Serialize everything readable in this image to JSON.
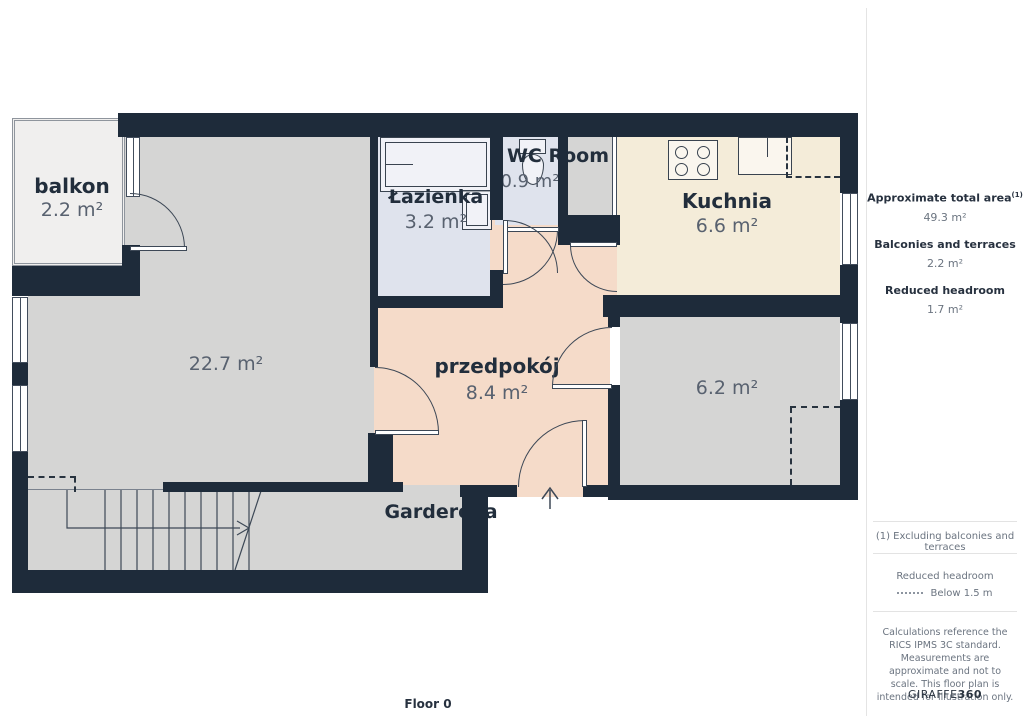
{
  "floor_plan": {
    "floor_label": "Floor 0",
    "rooms": [
      {
        "id": "balkon",
        "name": "balkon",
        "area": "2.2 m²"
      },
      {
        "id": "room_22_7",
        "name": "",
        "area": "22.7 m²"
      },
      {
        "id": "lazienka",
        "name": "Łazienka",
        "area": "3.2 m²"
      },
      {
        "id": "wc",
        "name": "WC Room",
        "area": "0.9 m²"
      },
      {
        "id": "kuchnia",
        "name": "Kuchnia",
        "area": "6.6 m²"
      },
      {
        "id": "przedpokoj",
        "name": "przedpokój",
        "area": "8.4 m²"
      },
      {
        "id": "room_6_2",
        "name": "",
        "area": "6.2 m²"
      },
      {
        "id": "garderoba",
        "name": "Garderoba",
        "area": ""
      }
    ],
    "colors": {
      "wall": "#1e2b3a",
      "room_gray": "#d5d5d4",
      "bathroom_blue": "#dfe3ed",
      "kitchen_beige": "#f4ecd9",
      "hallway_pink": "#f5dbc9",
      "balcony": "#f0efee"
    }
  },
  "sidebar": {
    "stats": [
      {
        "label": "Approximate total area",
        "sup": "(1)",
        "value": "49.3 m²"
      },
      {
        "label": "Balconies and terraces",
        "sup": "",
        "value": "2.2 m²"
      },
      {
        "label": "Reduced headroom",
        "sup": "",
        "value": "1.7 m²"
      }
    ],
    "footnote": "(1) Excluding balconies and terraces",
    "legend": {
      "title": "Reduced headroom",
      "item": "Below 1.5 m"
    },
    "disclaimer": "Calculations reference the RICS IPMS 3C standard. Measurements are approximate and not to scale. This floor plan is intended for illustration only.",
    "logo": {
      "part1": "GIRAFFE",
      "part2": "360"
    }
  }
}
